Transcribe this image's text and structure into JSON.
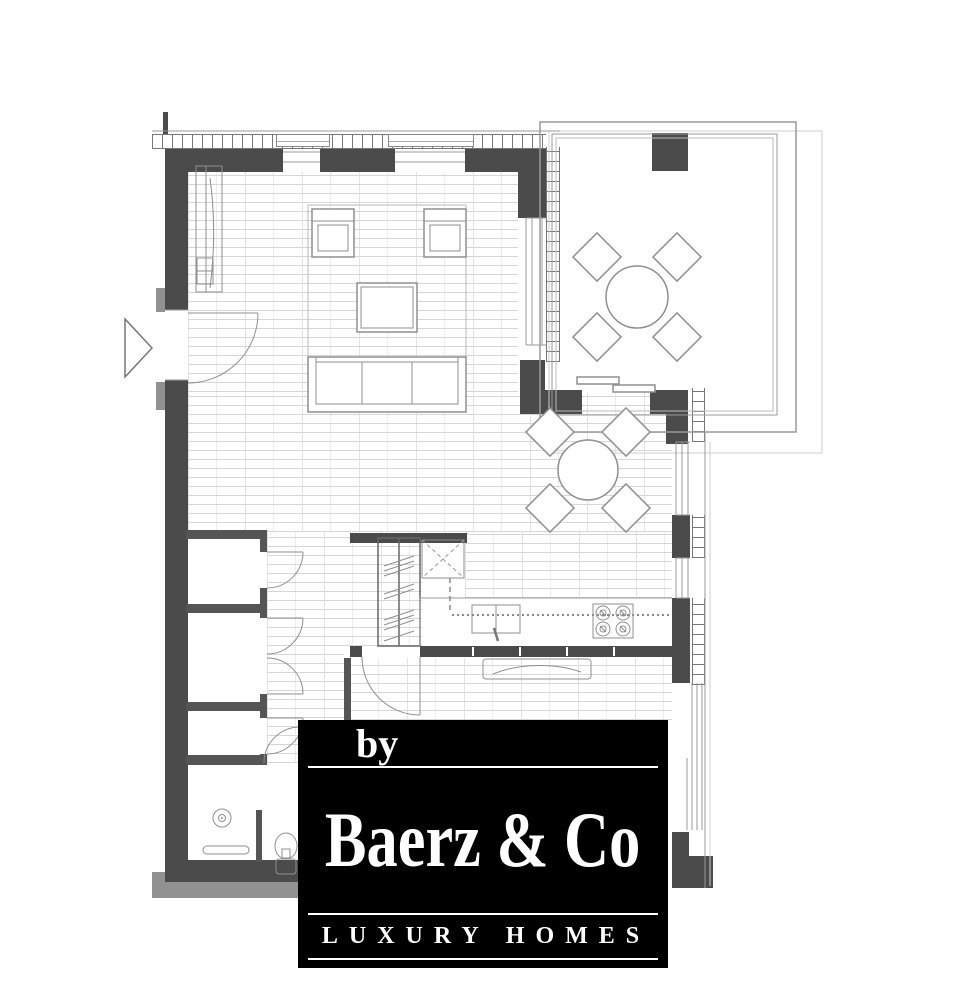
{
  "watermark": {
    "prefix": "by",
    "brand": "Baerz & Co",
    "tagline": "LUXURY HOMES",
    "background": "#000000",
    "text_color": "#ffffff"
  },
  "palette": {
    "wall": "#4b4b4b",
    "wall2": "#555555",
    "line": "#8f8f8f",
    "floorline": "#d6d6d6",
    "shadow": "#919191",
    "ink": "#000000",
    "paper": "#ffffff"
  },
  "plan": {
    "type": "apartment-floor-plan",
    "rooms": [
      "living-room",
      "dining-area",
      "kitchen",
      "hallway",
      "storage-closets",
      "bathroom",
      "bedroom",
      "terrace"
    ],
    "fixtures": [
      "entry-door",
      "entry-direction-triangle",
      "wardrobe-cabinet",
      "rug",
      "two-armchairs",
      "coffee-table",
      "sofa",
      "dining-table-with-4-chairs",
      "terrace-table-with-4-chairs",
      "tall-kitchen-cabinets",
      "service-shaft",
      "kitchen-sink",
      "cooktop-4-burners",
      "kitchen-counter",
      "sideboard",
      "sliding-terrace-door",
      "closet-doors",
      "shower",
      "bathroom-bench",
      "toilet"
    ]
  }
}
